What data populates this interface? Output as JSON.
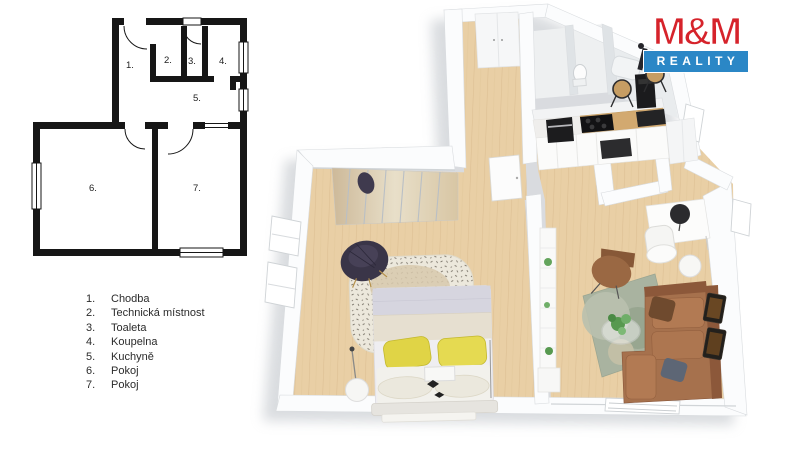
{
  "logo": {
    "name": "M&M",
    "tagline": "REALITY",
    "colors": {
      "red": "#d6232b",
      "blue": "#2b87c6"
    }
  },
  "legend": {
    "items": [
      {
        "number": "1.",
        "label": "Chodba"
      },
      {
        "number": "2.",
        "label": "Technická místnost"
      },
      {
        "number": "3.",
        "label": "Toaleta"
      },
      {
        "number": "4.",
        "label": "Koupelna"
      },
      {
        "number": "5.",
        "label": "Kuchyně"
      },
      {
        "number": "6.",
        "label": "Pokoj"
      },
      {
        "number": "7.",
        "label": "Pokoj"
      }
    ]
  },
  "plan2d": {
    "room_numbers": [
      "1.",
      "2.",
      "3.",
      "4.",
      "5.",
      "6.",
      "7."
    ]
  },
  "plan3d": {
    "colors": {
      "floor_wood": "#e9cfa5",
      "wall": "#fbfcfd",
      "sofa_brown": "#a6714d",
      "rug_green": "#a9b3a0",
      "pillow_yellow": "#e0d446",
      "bed_duvet": "#d6d5df"
    }
  }
}
